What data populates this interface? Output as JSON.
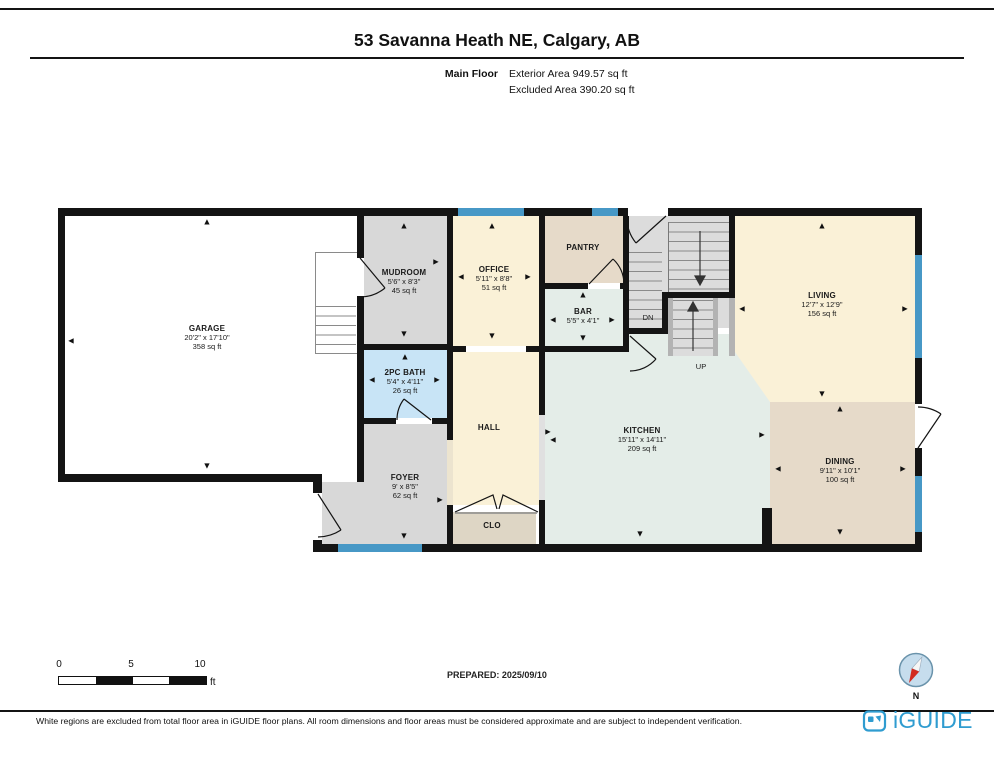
{
  "header": {
    "title": "53 Savanna Heath NE, Calgary, AB",
    "floor_label": "Main Floor",
    "exterior_area": "Exterior Area 949.57 sq ft",
    "excluded_area": "Excluded Area 390.20 sq ft"
  },
  "rooms": {
    "garage": {
      "name": "GARAGE",
      "dims": "20'2\" x 17'10\"",
      "area": "358 sq ft"
    },
    "mudroom": {
      "name": "MUDROOM",
      "dims": "5'6\" x 8'3\"",
      "area": "45 sq ft"
    },
    "office": {
      "name": "OFFICE",
      "dims": "5'11\" x 8'8\"",
      "area": "51 sq ft"
    },
    "pantry": {
      "name": "PANTRY"
    },
    "bar": {
      "name": "BAR",
      "dims": "5'5\" x 4'1\""
    },
    "living": {
      "name": "LIVING",
      "dims": "12'7\" x 12'9\"",
      "area": "156 sq ft"
    },
    "kitchen": {
      "name": "KITCHEN",
      "dims": "15'11\" x 14'11\"",
      "area": "209 sq ft"
    },
    "dining": {
      "name": "DINING",
      "dims": "9'11\" x 10'1\"",
      "area": "100 sq ft"
    },
    "bath": {
      "name": "2PC BATH",
      "dims": "5'4\" x 4'11\"",
      "area": "26 sq ft"
    },
    "hall": {
      "name": "HALL"
    },
    "foyer": {
      "name": "FOYER",
      "dims": "9' x 8'5\"",
      "area": "62 sq ft"
    },
    "closet": {
      "name": "CLO"
    }
  },
  "stairs": {
    "down": "DN",
    "up": "UP"
  },
  "glyphs": {
    "up": "▲",
    "down": "▼",
    "left": "◄",
    "right": "►"
  },
  "scale_bar": {
    "t0": "0",
    "t5": "5",
    "t10": "10",
    "unit": "ft"
  },
  "compass": {
    "label": "N"
  },
  "footer": {
    "prepared": "PREPARED: 2025/09/10",
    "disclaimer": "White regions are excluded from total floor area in iGUIDE floor plans. All room dimensions and floor areas must be considered approximate and are subject to independent verification.",
    "brand": "iGUIDE",
    "brand_color": "#2f9cd0"
  },
  "colors": {
    "wall": "#141414",
    "window": "#4798c6",
    "cream": "#faf1d7",
    "gray": "#d8d8d8",
    "tan": "#e6dac9",
    "mint": "#e4ede8",
    "bath_blue": "#c8e4f6",
    "clo": "#ded6c5",
    "stair": "#dcdcdc"
  }
}
